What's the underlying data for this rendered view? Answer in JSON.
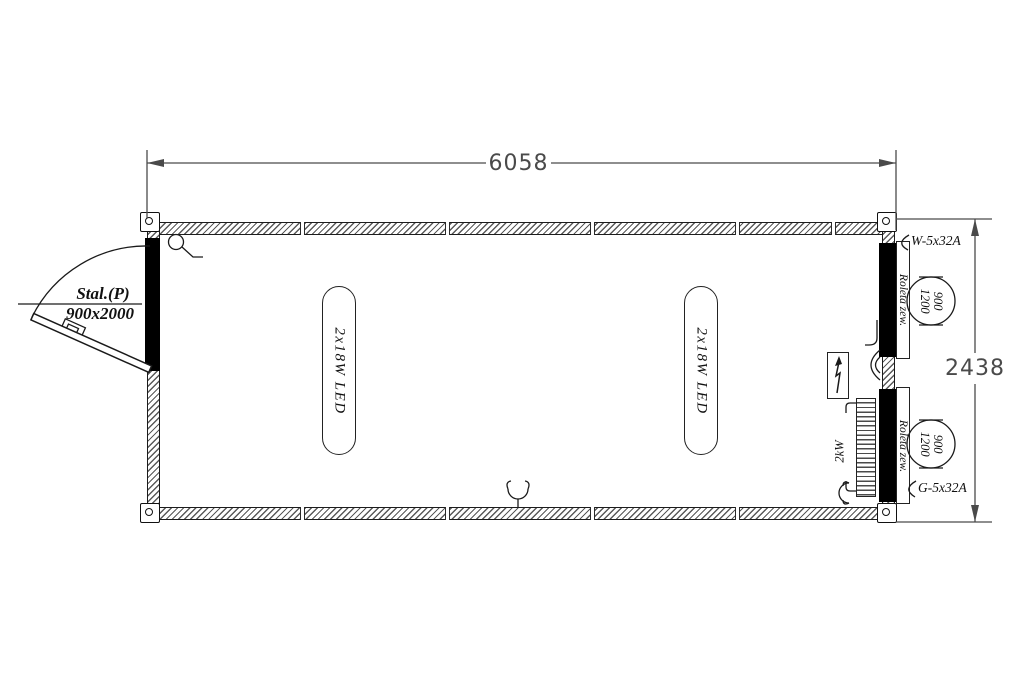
{
  "title": "Container floor plan",
  "dimensions": {
    "overall_width": "6058",
    "overall_height": "2438"
  },
  "door": {
    "type_label": "Stal.(P)",
    "size_label": "900x2000"
  },
  "lights": {
    "fixture_1_label": "2x18W LED",
    "fixture_2_label": "2x18W LED"
  },
  "windows": {
    "window_1": {
      "shutter_label": "Roleta zew.",
      "width": "900",
      "height": "1200"
    },
    "window_2": {
      "shutter_label": "Roleta zew.",
      "width": "900",
      "height": "1200"
    }
  },
  "electrical": {
    "power_inlet_label": "W-5x32A",
    "power_outlet_label": "G-5x32A",
    "heater_power_label": "2kW"
  }
}
